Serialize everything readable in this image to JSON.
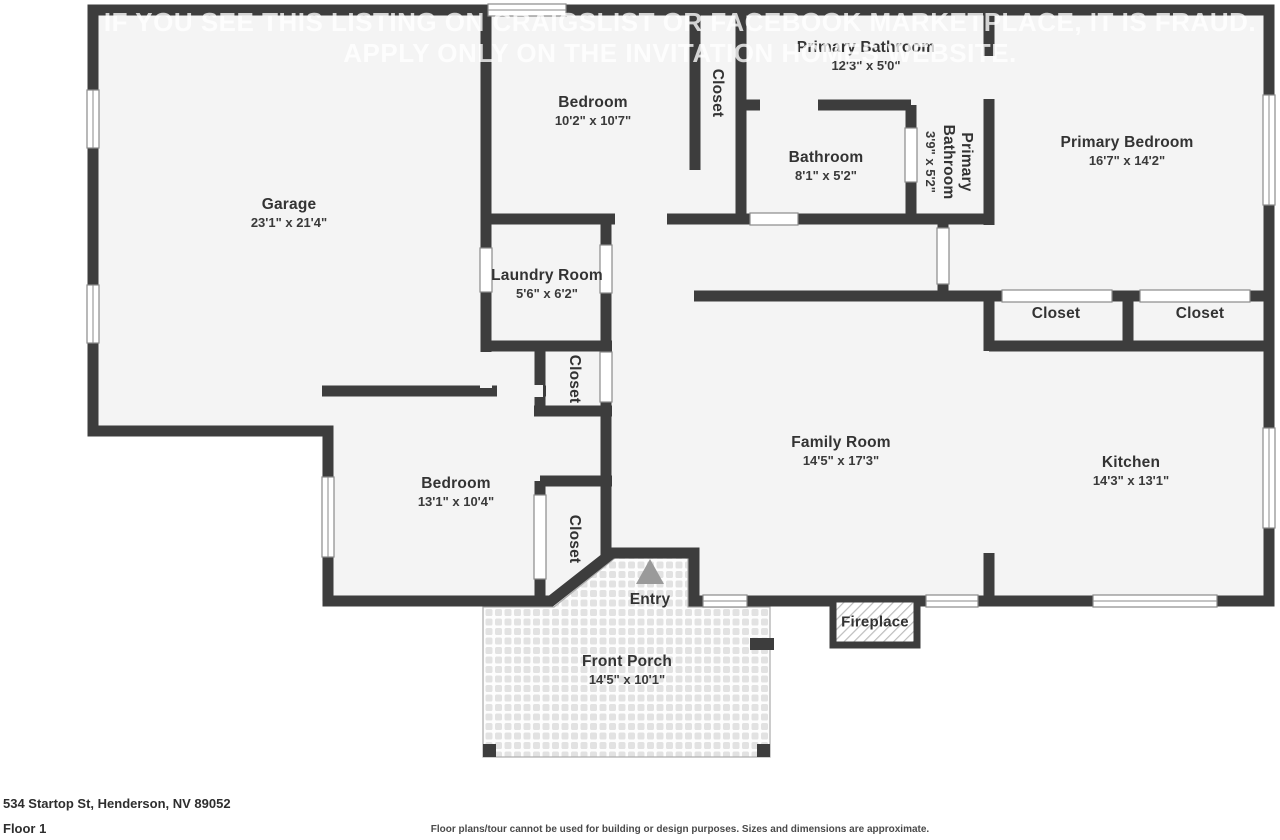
{
  "watermark": {
    "line1": "IF YOU SEE THIS LISTING ON CRAIGSLIST OR FACEBOOK MARKETPLACE, IT IS FRAUD.",
    "line2": "APPLY ONLY ON THE INVITATION HOMES WEBSITE."
  },
  "rooms": [
    {
      "name": "Garage",
      "dims": "23'1\" x 21'4\""
    },
    {
      "name": "Bedroom",
      "dims": "10'2\" x 10'7\""
    },
    {
      "name": "Closet"
    },
    {
      "name": "Primary Bathroom",
      "dims": "12'3\" x 5'0\""
    },
    {
      "name": "Bathroom",
      "dims": "8'1\" x 5'2\""
    },
    {
      "name": "Primary Bathroom",
      "dims": "3'9\" x 5'2\""
    },
    {
      "name": "Primary Bedroom",
      "dims": "16'7\" x 14'2\""
    },
    {
      "name": "Closet"
    },
    {
      "name": "Closet"
    },
    {
      "name": "Laundry Room",
      "dims": "5'6\" x 6'2\""
    },
    {
      "name": "Closet"
    },
    {
      "name": "Family Room",
      "dims": "14'5\" x 17'3\""
    },
    {
      "name": "Kitchen",
      "dims": "14'3\" x 13'1\""
    },
    {
      "name": "Bedroom",
      "dims": "13'1\" x 10'4\""
    },
    {
      "name": "Closet"
    },
    {
      "name": "Entry"
    },
    {
      "name": "Fireplace"
    },
    {
      "name": "Front Porch",
      "dims": "14'5\" x 10'1\""
    }
  ],
  "footer": {
    "address": "534 Startop St, Henderson, NV 89052",
    "floor_label": "Floor 1",
    "disclaimer": "Floor plans/tour cannot be used for building or design purposes. Sizes and dimensions are approximate."
  },
  "colors": {
    "wall": "#3d3d3d",
    "floor": "#f4f4f4",
    "watermark": "#ffffff"
  }
}
